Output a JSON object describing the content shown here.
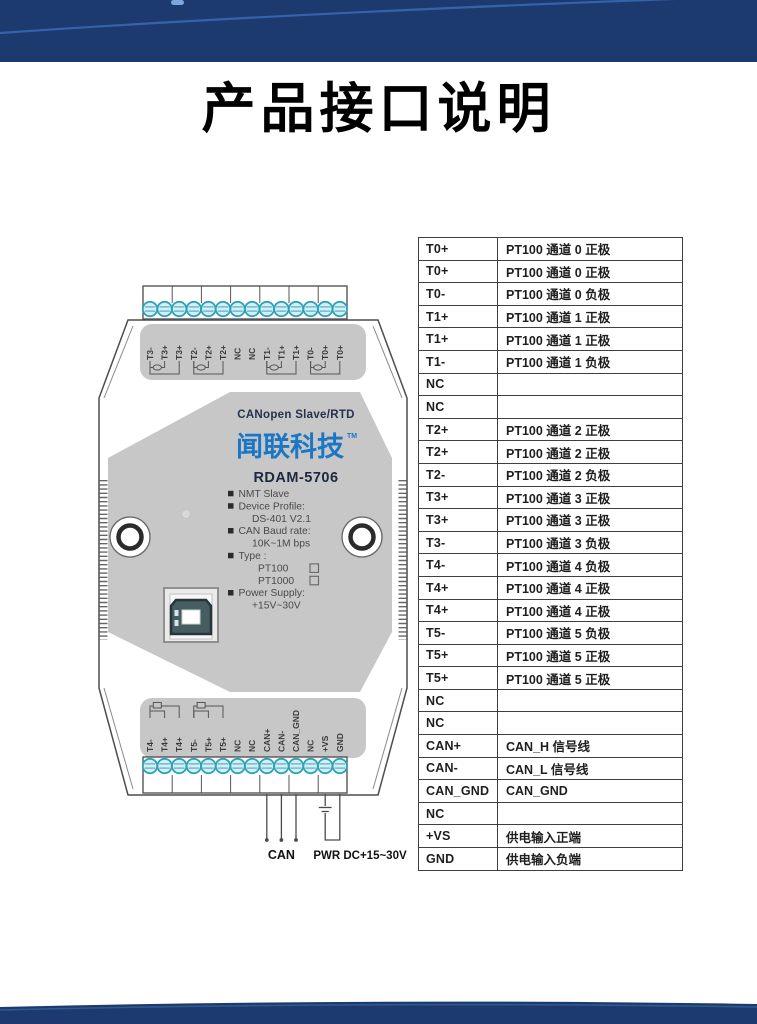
{
  "page": {
    "title": "产品接口说明"
  },
  "colors": {
    "band_navy": "#1c3a6e",
    "band_arc": "#3a67b4",
    "brand_blue": "#1b76c6",
    "panel_gray": "#c7c7c7",
    "screw_teal": "#2ba2b8"
  },
  "device": {
    "top_terminals": [
      "T3-",
      "T3+",
      "T3+",
      "T2-",
      "T2+",
      "T2+",
      "NC",
      "NC",
      "T1-",
      "T1+",
      "T1+",
      "T0-",
      "T0+",
      "T0+"
    ],
    "bottom_terminals": [
      "T4-",
      "T4+",
      "T4+",
      "T5-",
      "T5+",
      "T5+",
      "NC",
      "NC",
      "CAN+",
      "CAN-",
      "CAN_GND",
      "NC",
      "+VS",
      "GND"
    ],
    "panel": {
      "product_line": "CANopen Slave/RTD",
      "brand": "闻联科技",
      "trademark": "TM",
      "model": "RDAM-5706",
      "specs": [
        {
          "bullet": true,
          "checkbox": false,
          "text": "NMT Slave"
        },
        {
          "bullet": true,
          "checkbox": false,
          "text": "Device Profile:"
        },
        {
          "bullet": false,
          "checkbox": false,
          "text": "DS-401 V2.1"
        },
        {
          "bullet": true,
          "checkbox": false,
          "text": "CAN Baud rate:"
        },
        {
          "bullet": false,
          "checkbox": false,
          "text": "10K~1M bps"
        },
        {
          "bullet": true,
          "checkbox": false,
          "text": "Type :"
        },
        {
          "bullet": false,
          "checkbox": true,
          "text": "PT100"
        },
        {
          "bullet": false,
          "checkbox": true,
          "text": "PT1000"
        },
        {
          "bullet": true,
          "checkbox": false,
          "text": "Power Supply:"
        },
        {
          "bullet": false,
          "checkbox": false,
          "text": "+15V~30V"
        }
      ]
    },
    "wire_labels": {
      "can": "CAN",
      "power": "PWR DC+15~30V"
    }
  },
  "table": {
    "rows": [
      {
        "pin": "T0+",
        "desc": "PT100 通道 0 正极"
      },
      {
        "pin": "T0+",
        "desc": "PT100 通道 0 正极"
      },
      {
        "pin": "T0-",
        "desc": "PT100 通道 0 负极"
      },
      {
        "pin": "T1+",
        "desc": "PT100 通道 1 正极"
      },
      {
        "pin": "T1+",
        "desc": "PT100 通道 1 正极"
      },
      {
        "pin": "T1-",
        "desc": "PT100 通道 1 负极"
      },
      {
        "pin": "NC",
        "desc": ""
      },
      {
        "pin": "NC",
        "desc": ""
      },
      {
        "pin": "T2+",
        "desc": "PT100 通道 2 正极"
      },
      {
        "pin": "T2+",
        "desc": "PT100 通道 2 正极"
      },
      {
        "pin": "T2-",
        "desc": "PT100 通道 2 负极"
      },
      {
        "pin": "T3+",
        "desc": "PT100 通道 3 正极"
      },
      {
        "pin": "T3+",
        "desc": "PT100 通道 3 正极"
      },
      {
        "pin": "T3-",
        "desc": "PT100 通道 3 负极"
      },
      {
        "pin": "T4-",
        "desc": "PT100 通道 4 负极"
      },
      {
        "pin": "T4+",
        "desc": "PT100 通道 4 正极"
      },
      {
        "pin": "T4+",
        "desc": "PT100 通道 4 正极"
      },
      {
        "pin": "T5-",
        "desc": "PT100 通道 5 负极"
      },
      {
        "pin": "T5+",
        "desc": "PT100 通道 5 正极"
      },
      {
        "pin": "T5+",
        "desc": "PT100 通道 5 正极"
      },
      {
        "pin": "NC",
        "desc": ""
      },
      {
        "pin": "NC",
        "desc": ""
      },
      {
        "pin": "CAN+",
        "desc": "CAN_H 信号线"
      },
      {
        "pin": "CAN-",
        "desc": "CAN_L 信号线"
      },
      {
        "pin": "CAN_GND",
        "desc": "CAN_GND"
      },
      {
        "pin": "NC",
        "desc": ""
      },
      {
        "pin": "+VS",
        "desc": "供电输入正端"
      },
      {
        "pin": "GND",
        "desc": "供电输入负端"
      }
    ]
  }
}
